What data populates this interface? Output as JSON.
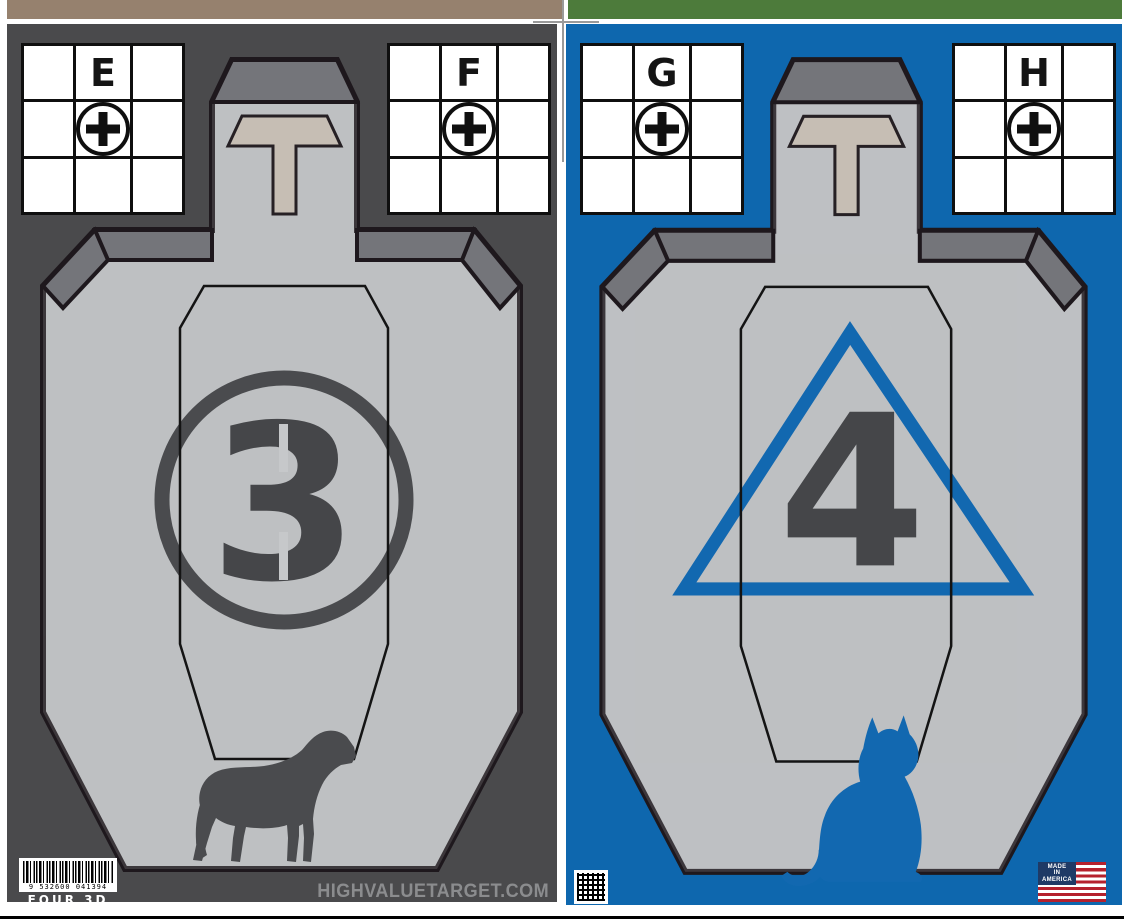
{
  "document": {
    "kind": "printable shooting target sheet pair",
    "bottom_rule": true
  },
  "sheets": [
    {
      "side": "left",
      "background_color": "#4a4a4c",
      "top_bar_color": "#96816e",
      "grids": [
        {
          "letter": "E"
        },
        {
          "letter": "F"
        }
      ],
      "marker": {
        "shape": "circle",
        "number": "3",
        "color": "#4a4b4e"
      },
      "animal": {
        "name": "dog",
        "color": "#4a4b4e"
      },
      "barcode": {
        "digits": "9 532600 041394",
        "label": "FOUR 3D"
      },
      "footer_url": "HIGHVALUETARGET.COM"
    },
    {
      "side": "right",
      "background_color": "#0e67ae",
      "top_bar_color": "#4d7b3b",
      "grids": [
        {
          "letter": "G"
        },
        {
          "letter": "H"
        }
      ],
      "marker": {
        "shape": "triangle",
        "number": "4",
        "color": "#1268b0"
      },
      "animal": {
        "name": "cat",
        "color": "#1268b0"
      },
      "badge": {
        "line1": "MADE",
        "line2": "IN",
        "line3": "AMERICA"
      }
    }
  ],
  "colors": {
    "silhouette_fill": "#c6c8ca",
    "silhouette_outline": "#1e181d",
    "bevel_gray": "#74757a",
    "t_zone_fill": "#c6beb4",
    "a_zone_outline": "#141414",
    "flag_red": "#b5212d",
    "flag_blue": "#1f3a66",
    "url_text_color": "#8b8c8e"
  }
}
